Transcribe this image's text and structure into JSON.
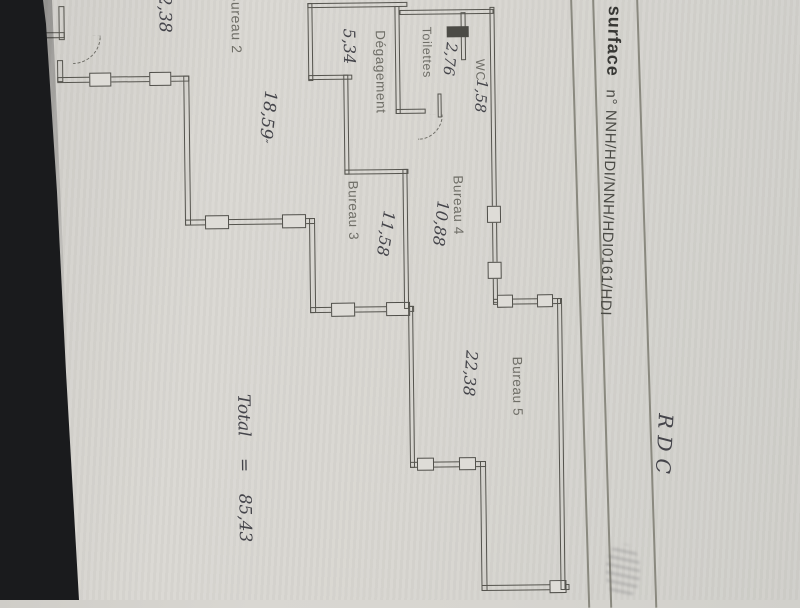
{
  "document": {
    "surface_label": "surface",
    "reference": "n° NNH/HDI/NNH/HDI0161/HDI",
    "floor_code": "RDC"
  },
  "plan": {
    "rooms": [
      {
        "name": "Bureau 2",
        "area": "18,59"
      },
      {
        "name": "Bureau 3",
        "area": "11,58"
      },
      {
        "name": "Bureau 4",
        "area": "10,88"
      },
      {
        "name": "Bureau 5",
        "area": "22,38"
      },
      {
        "name": "Dégagement",
        "area": "5,34"
      },
      {
        "name": "Toilettes",
        "area": "2,76"
      },
      {
        "name": "WC",
        "area": "1,58"
      }
    ],
    "annotations": {
      "edge_dimension": "2,38",
      "bureau2_mark": "″",
      "total_label": "Total",
      "equals_sign": "=",
      "total_value": "85,43"
    }
  },
  "colors": {
    "paper": "#d8d6d1",
    "plan_ink": "#55544e",
    "handwriting_ink": "#44444a",
    "background_shadow": "#1a1b1d"
  }
}
